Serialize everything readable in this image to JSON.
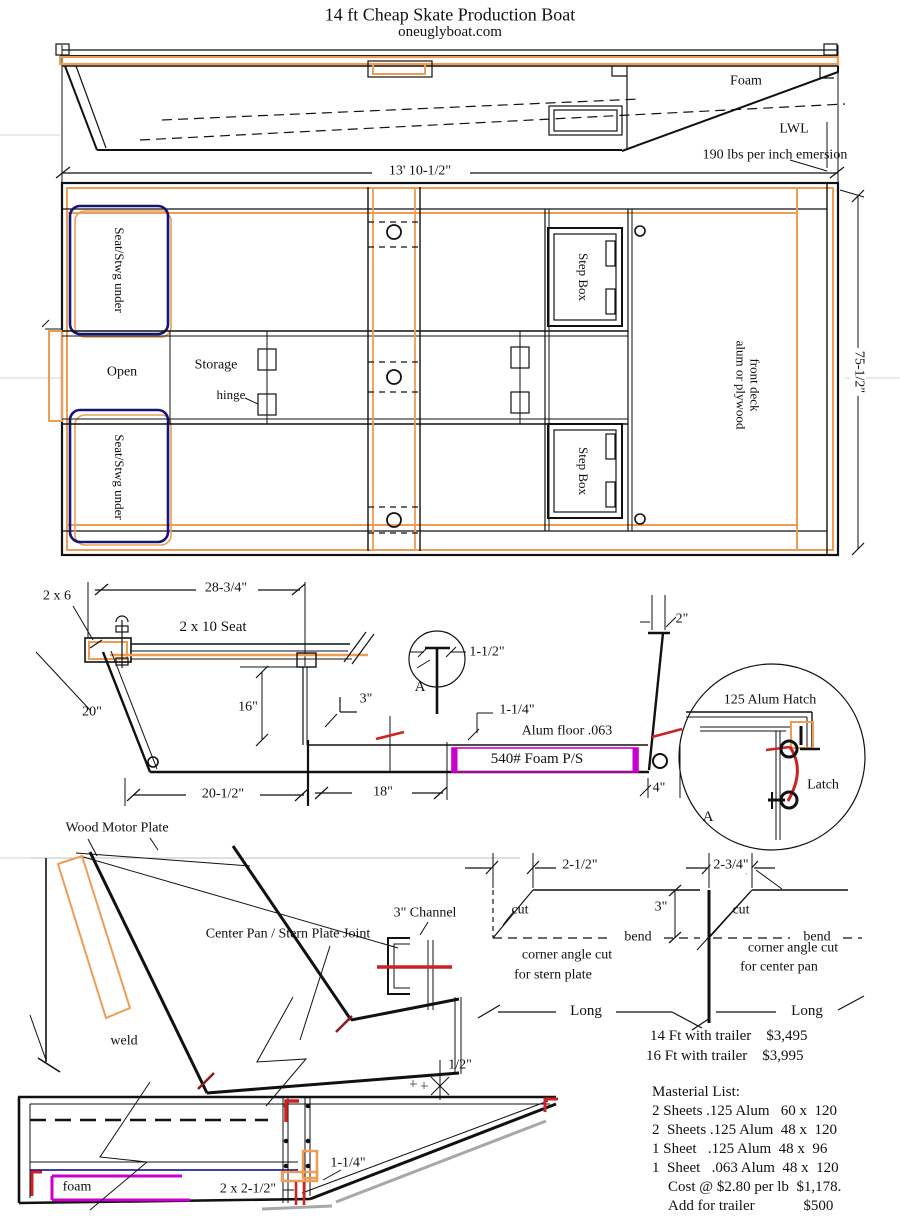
{
  "header": {
    "title": "14 ft Cheap Skate Production Boat",
    "subtitle": "oneuglyboat.com"
  },
  "side_view": {
    "foam": "Foam",
    "lwl": "LWL",
    "emersion": "190 lbs per inch emersion",
    "length_dim": "13' 10-1/2\""
  },
  "plan_view": {
    "seat_fwd": "Seat/Stwg under",
    "seat_aft": "Seat/Stwg under",
    "open": "Open",
    "storage": "Storage",
    "hinge": "hinge",
    "step_box_top": "Step Box",
    "step_box_bottom": "Step Box",
    "front_deck_line1": "front deck",
    "front_deck_line2": "alum or plywood",
    "beam_dim": "75-1/2\""
  },
  "section_view": {
    "lumber": "2 x 6",
    "seat_width": "28-3/4\"",
    "seat": "2 x 10 Seat",
    "side_depth": "20\"",
    "wall_height": "16\"",
    "three": "3\"",
    "detail_a": "A",
    "one_half": "1-1/2\"",
    "one_quarter": "1-1/4\"",
    "alum_floor": "Alum floor .063",
    "foam": "540# Foam P/S",
    "bottom_len": "20-1/2\"",
    "floor_len": "18\"",
    "four": "4\"",
    "two": "2\""
  },
  "hatch_detail": {
    "hatch": "125 Alum Hatch",
    "latch": "Latch",
    "a": "A"
  },
  "stern_joint": {
    "motor_plate": "Wood Motor Plate",
    "joint": "Center Pan / Stern Plate Joint",
    "channel": "3\" Channel",
    "weld": "weld",
    "half": "1/2\""
  },
  "corner_cuts": {
    "left": {
      "dim": "2-1/2\"",
      "cut": "cut",
      "three": "3\"",
      "bend": "bend",
      "caption1": "corner angle cut",
      "caption2": "for stern plate",
      "long": "Long"
    },
    "right": {
      "dim": "2-3/4\"",
      "cut": "cut",
      "bend": "bend",
      "caption1": "corner angle cut",
      "caption2": "for center pan",
      "long": "Long"
    }
  },
  "pricing": {
    "row1": "14 Ft with trailer    $3,495",
    "row2": "16 Ft with trailer    $3,995"
  },
  "materials": {
    "heading": "Masterial List:",
    "rows": [
      "2 Sheets .125 Alum   60 x  120",
      "2  Sheets .125 Alum  48 x  120",
      "1 Sheet   .125 Alum  48 x  96",
      "1  Sheet   .063 Alum  48 x  120"
    ],
    "cost": "Cost @ $2.80 per lb  $1,178.",
    "trailer": "Add for trailer             $500"
  },
  "bottom_view": {
    "foam": "foam",
    "cleat": "2 x 2-1/2\"",
    "lip": "1-1/4\""
  },
  "colors": {
    "accent_orange": "#EE9D55",
    "seat_navy": "#14147A",
    "foam_magenta": "#CC00CC",
    "weld_red": "#CC2222",
    "joint_darkred": "#8B1A1A",
    "shadow_gray": "#A8A8A8"
  }
}
